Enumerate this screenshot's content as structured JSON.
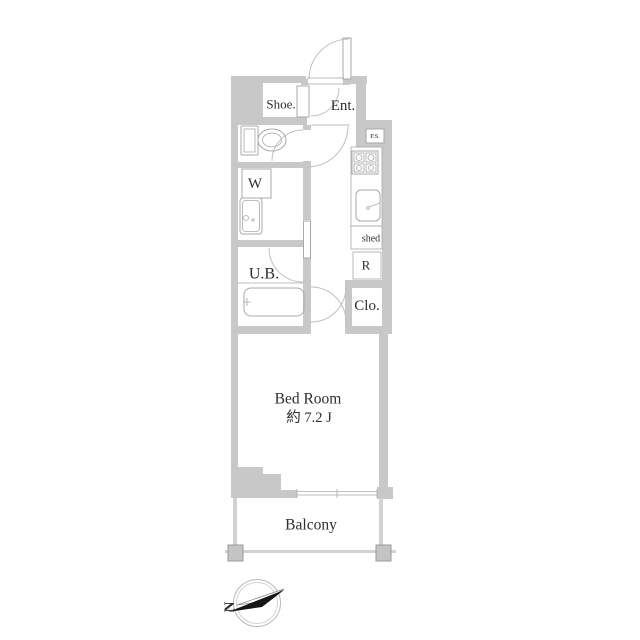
{
  "title": "apartment-floor-plan",
  "rooms": {
    "shoe": {
      "label": "Shoe."
    },
    "ent": {
      "label": "Ent."
    },
    "ps": {
      "label": "P.S."
    },
    "washer": {
      "label": "W"
    },
    "ub": {
      "label": "U.B."
    },
    "shed": {
      "label": "shed"
    },
    "fridge": {
      "label": "R"
    },
    "closet": {
      "label": "Clo."
    },
    "bedroom": {
      "label": "Bed Room",
      "size": "約 7.2 J"
    },
    "balcony": {
      "label": "Balcony"
    }
  },
  "compass": {
    "label": "N"
  },
  "colors": {
    "wall": "#c8c8c8",
    "wall_light": "#d2d2d2",
    "fixture": "#a9a9a9",
    "arc": "#c0c0c0",
    "text": "#2e2e2e",
    "black": "#161616",
    "background": "#ffffff"
  }
}
